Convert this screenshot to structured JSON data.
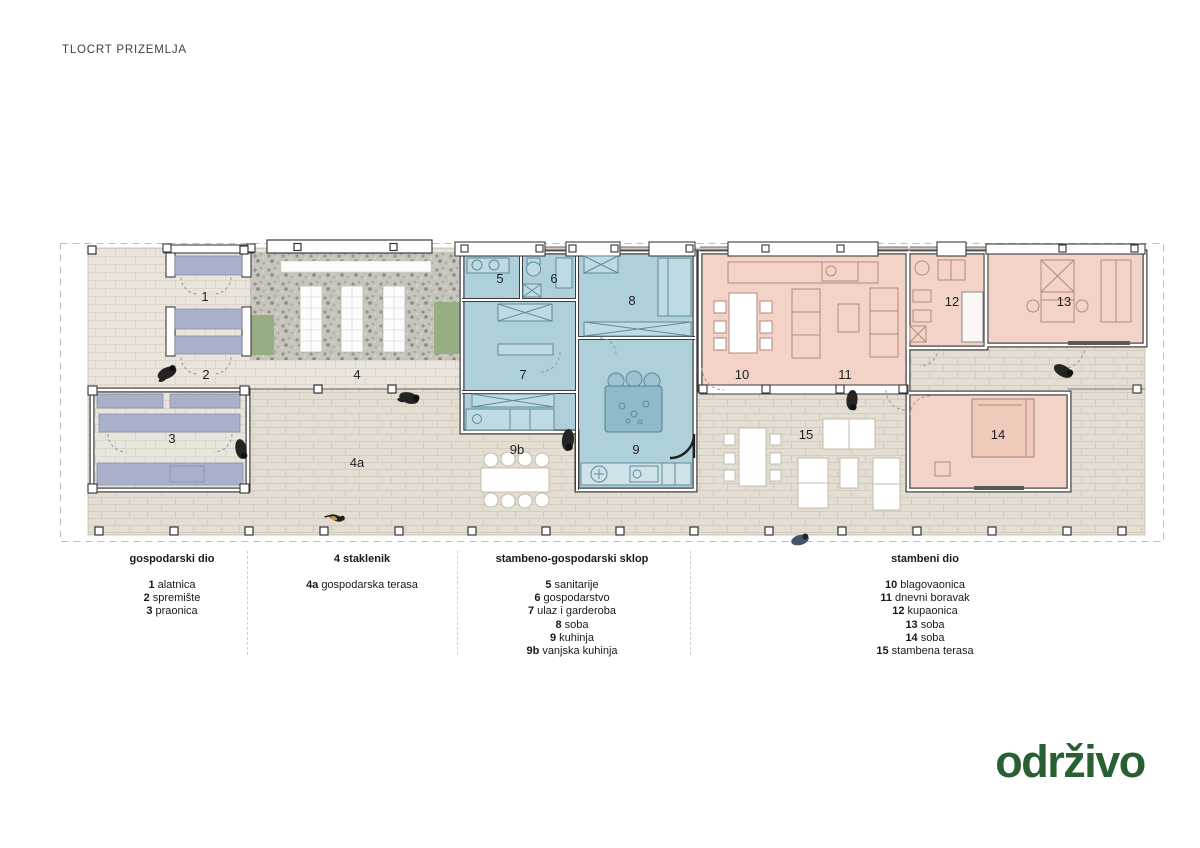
{
  "title": "TLOCRT PRIZEMLJA",
  "logo": {
    "text": "održivo"
  },
  "plan": {
    "room_labels": [
      "1",
      "2",
      "3",
      "4",
      "4a",
      "5",
      "6",
      "7",
      "8",
      "9",
      "9b",
      "10",
      "11",
      "12",
      "13",
      "14",
      "15"
    ]
  },
  "legend": {
    "sections": [
      {
        "title": "gospodarski dio",
        "items": [
          {
            "num": "1",
            "name": "alatnica"
          },
          {
            "num": "2",
            "name": "spremište"
          },
          {
            "num": "3",
            "name": "praonica"
          }
        ]
      },
      {
        "title": "4 staklenik",
        "items": [
          {
            "num": "4a",
            "name": "gospodarska terasa"
          }
        ]
      },
      {
        "title": "stambeno-gospodarski sklop",
        "items": [
          {
            "num": "5",
            "name": "sanitarije"
          },
          {
            "num": "6",
            "name": "gospodarstvo"
          },
          {
            "num": "7",
            "name": "ulaz i garderoba"
          },
          {
            "num": "8",
            "name": "soba"
          },
          {
            "num": "9",
            "name": "kuhinja"
          },
          {
            "num": "9b",
            "name": "vanjska kuhinja"
          }
        ]
      },
      {
        "title": "stambeni dio",
        "items": [
          {
            "num": "10",
            "name": "blagovaonica"
          },
          {
            "num": "11",
            "name": "dnevni boravak"
          },
          {
            "num": "12",
            "name": "kupaonica"
          },
          {
            "num": "13",
            "name": "soba"
          },
          {
            "num": "14",
            "name": "soba"
          },
          {
            "num": "15",
            "name": "stambena terasa"
          }
        ]
      }
    ]
  },
  "colors": {
    "blue_zone": "#aed0da",
    "pink_zone": "#f3d3c8",
    "lavender_furniture": "#a9b0c9",
    "grass": "#97ad82",
    "gravel": "#c7c4be",
    "paving": "#eae5dc",
    "walls": "#3d3d3d",
    "logo_green": "#2a5f33"
  }
}
